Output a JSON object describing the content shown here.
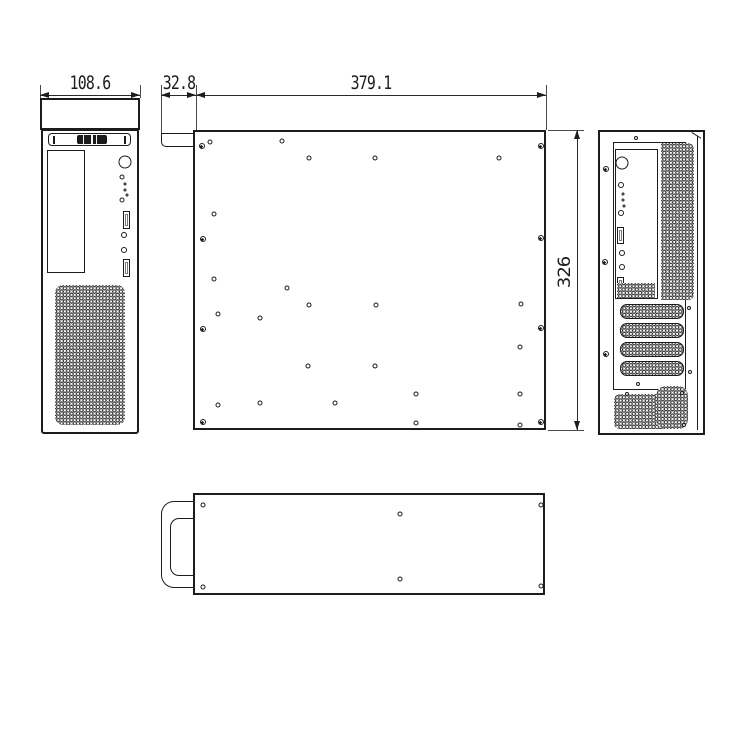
{
  "drawing": {
    "type": "mechanical-orthographic-views",
    "subject": "small form factor computer chassis",
    "line_color": "#1c1c1c",
    "background": "#ffffff",
    "dimensions": {
      "front_width": {
        "label": "108.6"
      },
      "bezel_depth": {
        "label": "32.8"
      },
      "body_length": {
        "label": "379.1"
      },
      "body_height": {
        "label": "326"
      }
    },
    "side_view": {
      "corner_screws": [
        [
          7,
          14
        ],
        [
          8,
          107
        ],
        [
          8,
          197
        ],
        [
          8,
          290
        ],
        [
          346,
          14
        ],
        [
          346,
          106
        ],
        [
          346,
          196
        ],
        [
          346,
          290
        ]
      ],
      "mount_holes": [
        [
          15,
          10
        ],
        [
          87,
          9
        ],
        [
          114,
          26
        ],
        [
          180,
          26
        ],
        [
          304,
          26
        ],
        [
          19,
          82
        ],
        [
          19,
          147
        ],
        [
          92,
          156
        ],
        [
          114,
          173
        ],
        [
          181,
          173
        ],
        [
          326,
          172
        ],
        [
          23,
          182
        ],
        [
          65,
          186
        ],
        [
          325,
          215
        ],
        [
          113,
          234
        ],
        [
          180,
          234
        ],
        [
          221,
          262
        ],
        [
          325,
          262
        ],
        [
          23,
          273
        ],
        [
          65,
          271
        ],
        [
          140,
          271
        ],
        [
          221,
          291
        ],
        [
          325,
          293
        ]
      ]
    },
    "rear_view": {
      "edge_screws": [
        [
          6,
          37
        ],
        [
          5,
          130
        ],
        [
          6,
          222
        ]
      ],
      "small_holes": [
        [
          36,
          6
        ],
        [
          89,
          176
        ],
        [
          90,
          240
        ],
        [
          38,
          252
        ],
        [
          27,
          262
        ],
        [
          82,
          261
        ],
        [
          84,
          293
        ]
      ]
    },
    "bottom_view": {
      "corner_holes": [
        [
          8,
          10
        ],
        [
          346,
          10
        ],
        [
          8,
          92
        ],
        [
          346,
          91
        ]
      ],
      "surface_holes": [
        [
          205,
          19
        ],
        [
          205,
          84
        ]
      ]
    }
  }
}
